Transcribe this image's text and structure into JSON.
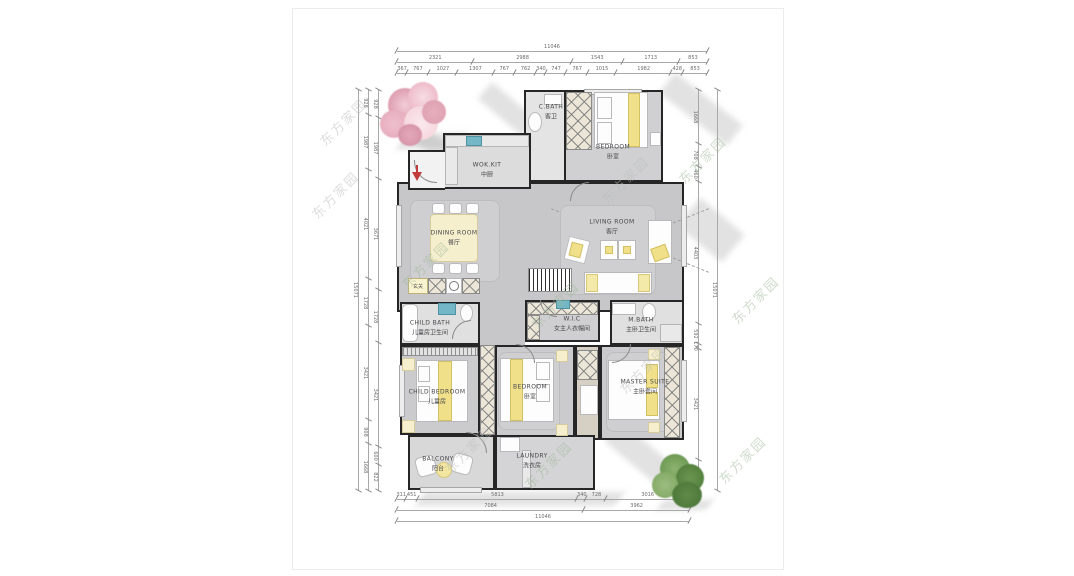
{
  "watermark": {
    "text": "东方家园"
  },
  "rooms": {
    "cbath": {
      "en": "C.BATH",
      "cn": "客卫"
    },
    "bedroom_top": {
      "en": "BEDROOM",
      "cn": "卧室"
    },
    "wok_kit": {
      "en": "WOK.KIT",
      "cn": "中厨"
    },
    "dining": {
      "en": "DINING ROOM",
      "cn": "餐厅"
    },
    "living": {
      "en": "LIVING ROOM",
      "cn": "客厅"
    },
    "child_bath": {
      "en": "CHILD BATH",
      "cn": "儿童房卫生间"
    },
    "wic": {
      "en": "W.I.C",
      "cn": "女主人衣帽间"
    },
    "mbath": {
      "en": "M.BATH",
      "cn": "主卧卫生间"
    },
    "child_bedroom": {
      "en": "CHILD BEDROOM",
      "cn": "儿童房"
    },
    "bedroom_mid": {
      "en": "BEDROOM",
      "cn": "卧室"
    },
    "master": {
      "en": "MASTER SUITE",
      "cn": "主卧套间"
    },
    "balcony": {
      "en": "BALCONY",
      "cn": "阳台"
    },
    "laundry": {
      "en": "LAUNDRY",
      "cn": "洗衣房"
    },
    "entry_cabinet": {
      "cn": "玄关"
    }
  },
  "dims": {
    "top_row1": [
      "11046"
    ],
    "top_row2": [
      "2321",
      "2988",
      "1543",
      "1713",
      "853"
    ],
    "top_row3": [
      "367",
      "767",
      "1027",
      "1307",
      "767",
      "762",
      "340",
      "747",
      "767",
      "1015",
      "1982",
      "428",
      "853"
    ],
    "bottom_row1": [
      "311",
      "451",
      "5813",
      "340",
      "728",
      "3016"
    ],
    "bottom_row2": [
      "7084",
      "3962"
    ],
    "bottom_row3": [
      "11046"
    ],
    "left_outer": [
      "15071"
    ],
    "left_mid": [
      "928",
      "1987",
      "4021",
      "1728",
      "3421",
      "908",
      "1668"
    ],
    "left_inner": [
      "928",
      "1987",
      "3671",
      "1728",
      "3421",
      "600",
      "822"
    ],
    "right_inner": [
      "1668",
      "708",
      "460",
      "4403",
      "592",
      "170",
      "3421",
      "929"
    ],
    "right_outer": [
      "15071"
    ]
  },
  "colors": {
    "wall": "#262626",
    "floor_gray": "#c7c7c9",
    "accent_yellow": "#f0e08a",
    "sink_blue": "#74b7c6",
    "entry_arrow_red": "#c23b3b",
    "watermark_green": "#9fb89a",
    "watermark_gray": "#b9bdb9"
  }
}
